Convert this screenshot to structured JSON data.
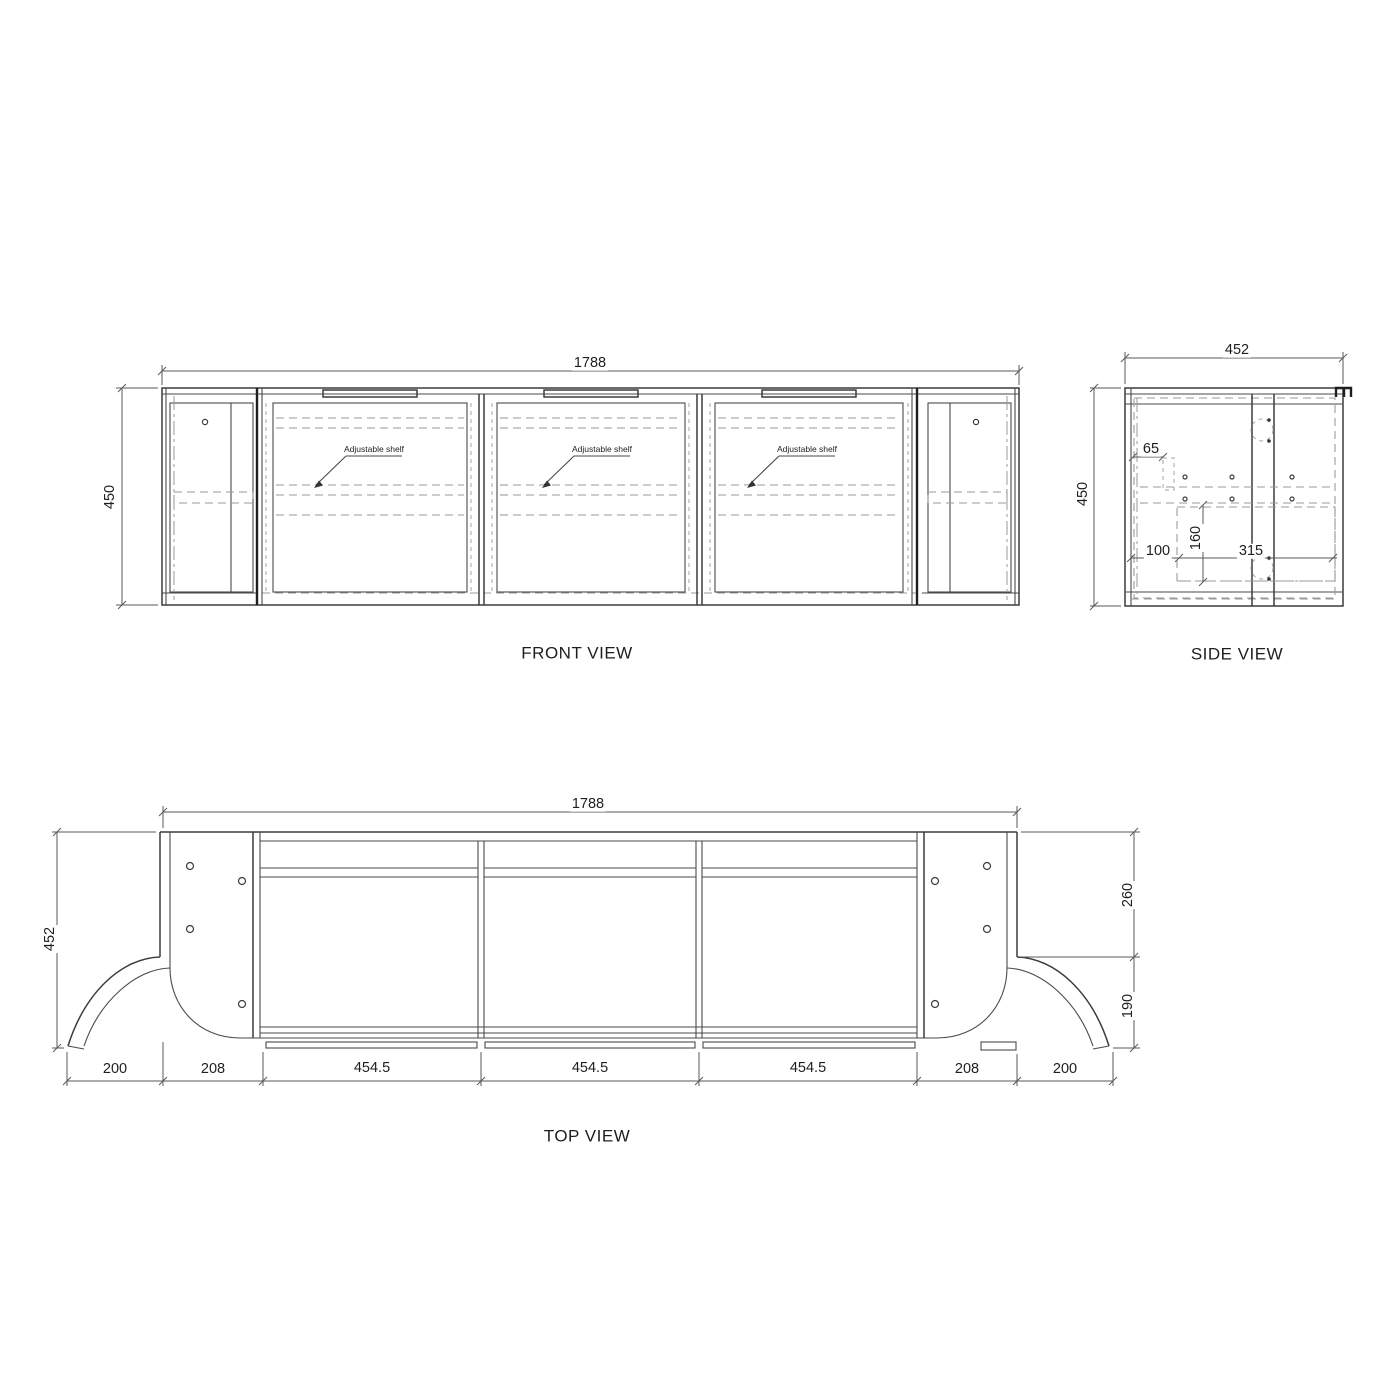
{
  "drawing": {
    "type": "cabinet technical drawing",
    "colors": {
      "line": "#3c3c3c",
      "dashed_line": "#9a9a9a",
      "background": "#ffffff"
    }
  },
  "front_view": {
    "title": "FRONT VIEW",
    "dim_width": "1788",
    "dim_height": "450",
    "shelf_labels": [
      "Adjustable shelf",
      "Adjustable shelf",
      "Adjustable shelf"
    ]
  },
  "side_view": {
    "title": "SIDE VIEW",
    "dim_width": "452",
    "dim_height": "450",
    "dim_65": "65",
    "dim_100": "100",
    "dim_160": "160",
    "dim_315": "315"
  },
  "top_view": {
    "title": "TOP VIEW",
    "dim_width": "1788",
    "dim_depth": "452",
    "dim_right_upper": "260",
    "dim_right_lower": "190",
    "dim_bottom": [
      "200",
      "208",
      "454.5",
      "454.5",
      "454.5",
      "208",
      "200"
    ]
  }
}
